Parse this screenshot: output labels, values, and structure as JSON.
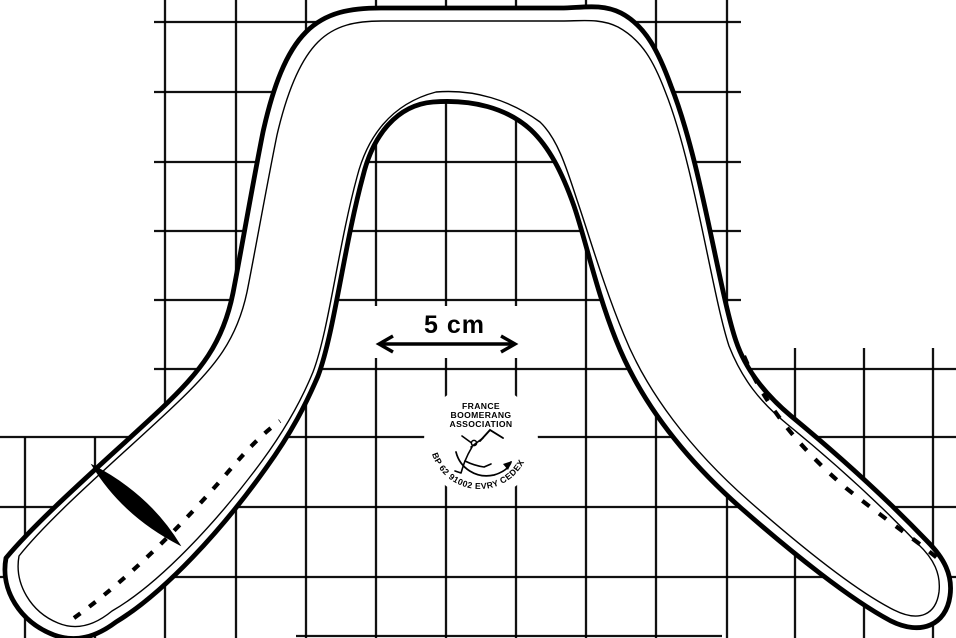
{
  "diagram": {
    "scale": {
      "label": "5 cm"
    },
    "logo": {
      "line1": "FRANCE",
      "line2": "BOOMERANG",
      "line3": "ASSOCIATION",
      "arc": "BP 62 91002 EVRY CEDEX"
    },
    "colors": {
      "ink": "#000000",
      "paper": "#ffffff"
    },
    "icons": {
      "figure": "boomerang-thrower-icon",
      "scale_arrow": "double-headed-arrow-icon"
    }
  }
}
